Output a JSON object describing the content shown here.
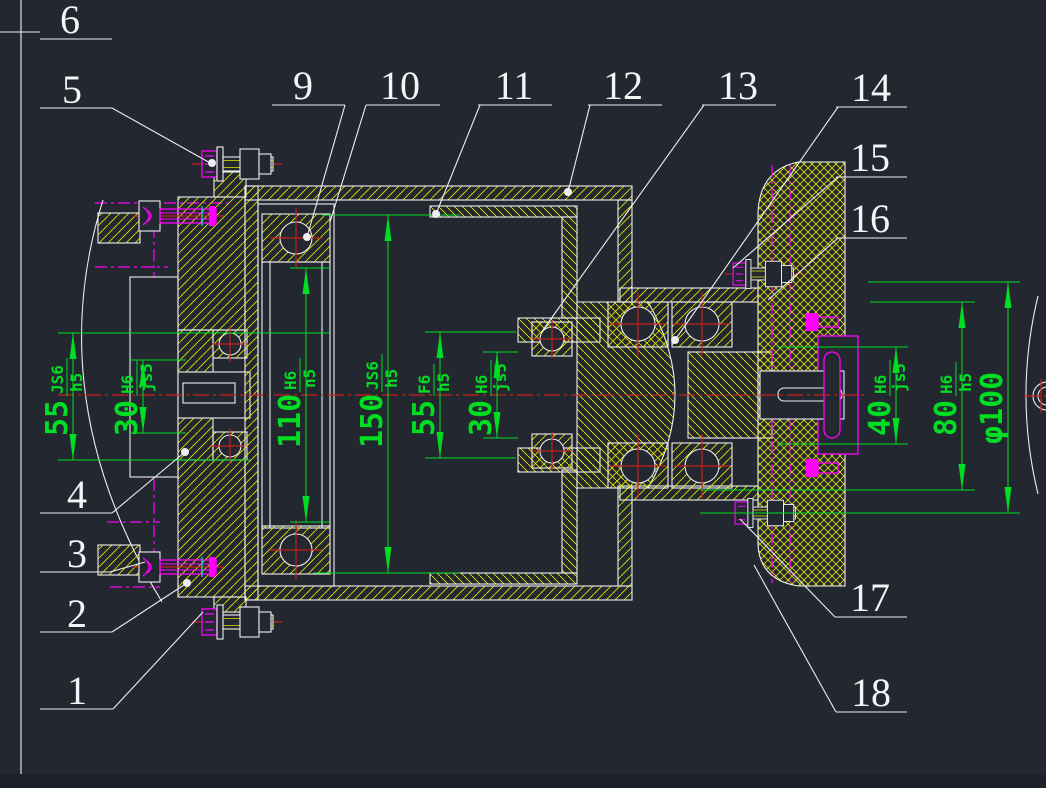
{
  "drawing": {
    "type": "mechanical-assembly-section",
    "colors": {
      "background": "#232830",
      "geometry": "#eeeef0",
      "hatch": "#e3e300",
      "dimension": "#00dd22",
      "centerline": "#c81e1e",
      "phantom": "#ff00ff",
      "accent": "#00e5e5"
    }
  },
  "part_labels": [
    {
      "number": "1"
    },
    {
      "number": "2"
    },
    {
      "number": "3"
    },
    {
      "number": "4"
    },
    {
      "number": "5"
    },
    {
      "number": "6"
    },
    {
      "number": "9"
    },
    {
      "number": "10"
    },
    {
      "number": "11"
    },
    {
      "number": "12"
    },
    {
      "number": "13"
    },
    {
      "number": "14"
    },
    {
      "number": "15"
    },
    {
      "number": "16"
    },
    {
      "number": "17"
    },
    {
      "number": "18"
    }
  ],
  "dimensions": [
    {
      "value": "55",
      "fit_upper": "JS6",
      "fit_lower": "h5"
    },
    {
      "value": "30",
      "fit_upper": "H6",
      "fit_lower": "js5"
    },
    {
      "value": "110",
      "fit_upper": "H6",
      "fit_lower": "n5"
    },
    {
      "value": "150",
      "fit_upper": "JS6",
      "fit_lower": "h5"
    },
    {
      "value": "55",
      "fit_upper": "F6",
      "fit_lower": "h5"
    },
    {
      "value": "30",
      "fit_upper": "H6",
      "fit_lower": "js5"
    },
    {
      "value": "40",
      "fit_upper": "H6",
      "fit_lower": "js5"
    },
    {
      "value": "80",
      "fit_upper": "H6",
      "fit_lower": "h5"
    },
    {
      "value": "φ100",
      "fit_upper": "",
      "fit_lower": ""
    }
  ]
}
